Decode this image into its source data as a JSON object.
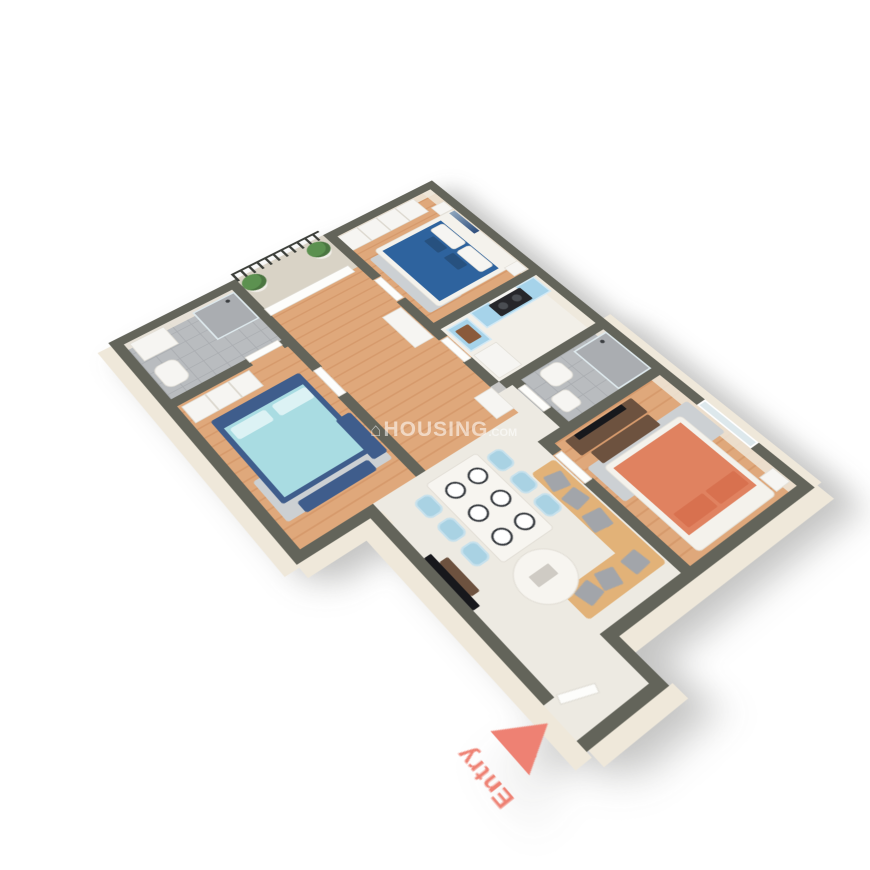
{
  "watermark": {
    "icon": "⌂",
    "text": "HOUSING",
    "suffix": ".COM",
    "color": "rgba(255,255,255,0.55)"
  },
  "entry": {
    "label": "Entry"
  },
  "colors": {
    "bg": "#ffffff",
    "wallTop": "#63645a",
    "wallFace": "#efe8da",
    "wood1": "#dfa87b",
    "wood2": "#d69a6c",
    "marble": "#edeae2",
    "marbleLt": "#f2efe8",
    "tile1": "#b9bcbf",
    "tile2": "#aaadb1",
    "balcony": "#d9d3c6",
    "railing": "#3c3f3a",
    "plant": "#5c9150",
    "pot": "#f2efe9",
    "bedBlue": "#2e639e",
    "bedBlueDark": "#27517f",
    "bedAqua": "#a9dce2",
    "aquaPillow": "#dcf2f4",
    "bedNavy": "#3f5d8c",
    "bedCoral": "#e08260",
    "bedCoralDark": "#d8714f",
    "frameWhite": "#f4f2ec",
    "sofa": "#e2b278",
    "cushion": "#a2a5aa",
    "chairBlue": "#a9d2e3",
    "tableWhite": "#f7f5f0",
    "kitchenCab": "#a6d3ea",
    "cooktop": "#26262a",
    "sinkBasin": "#8a5a3b",
    "appliance": "#f6f5f2",
    "rug": "#ccd0d3",
    "woodDark": "#6d523f",
    "tvDark": "#17181c",
    "glass": "#dde8ec",
    "entryAccent": "#ee8173",
    "watermark": "rgba(255,255,255,0.55)"
  },
  "scene": {
    "type": "isometric-3d-floor-plan",
    "rooms": [
      {
        "name": "master-bathroom",
        "floor": "gray-tile",
        "furniture": [
          "vanity",
          "toilet",
          "shower"
        ]
      },
      {
        "name": "balcony",
        "floor": "concrete",
        "furniture": [
          "iron-railing",
          "plant",
          "plant"
        ]
      },
      {
        "name": "bedroom-top",
        "floor": "wood",
        "furniture": [
          "wardrobe",
          "double-bed-blue",
          "nightstands",
          "rug",
          "wall-art"
        ]
      },
      {
        "name": "kitchen",
        "floor": "marble",
        "furniture": [
          "sink-cabinet",
          "refrigerator",
          "stove-counter",
          "hood"
        ]
      },
      {
        "name": "common-bathroom",
        "floor": "gray-tile",
        "furniture": [
          "shower",
          "toilet",
          "sink",
          "washbasin-outside"
        ]
      },
      {
        "name": "bedroom-right",
        "floor": "wood",
        "furniture": [
          "tv-dresser",
          "bench",
          "double-bed-coral",
          "nightstands",
          "rug",
          "window"
        ]
      },
      {
        "name": "master-bedroom",
        "floor": "wood",
        "furniture": [
          "wardrobe",
          "double-bed-aqua",
          "bench",
          "dresser",
          "rug"
        ]
      },
      {
        "name": "passage",
        "floor": "wood",
        "furniture": [
          "balcony-door",
          "shoe-cabinet",
          "washbasin"
        ]
      },
      {
        "name": "living-dining",
        "floor": "marble",
        "furniture": [
          "dining-table",
          "six-chairs",
          "six-plates",
          "l-sofa",
          "cushions",
          "round-coffee-table",
          "wall-tv",
          "tv-console"
        ]
      },
      {
        "name": "entry-vestibule",
        "floor": "marble",
        "furniture": [
          "entry-door",
          "entry-arrow"
        ]
      }
    ]
  }
}
